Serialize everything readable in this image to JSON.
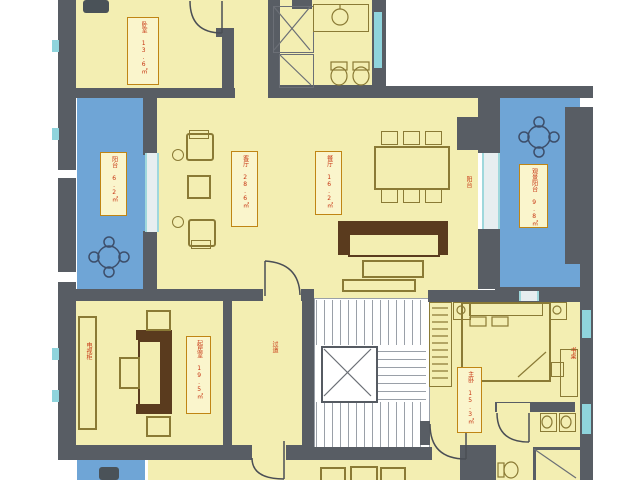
{
  "title": "apartment-floor-plan",
  "colors": {
    "room_fill": "#f3eeb2",
    "balcony_fill": "#6fa5d6",
    "wall": "#585d64",
    "label_border": "#c08514",
    "label_fill": "#faf5cc",
    "label_text": "#c63310",
    "window": "#8fd4dc",
    "furniture": "#8a7a35",
    "sofa": "#5a3b1e"
  },
  "rooms": {
    "bedroom_top": {
      "label": "卧室 13.6㎡"
    },
    "balcony_left": {
      "label": "阳台 6.2㎡"
    },
    "living": {
      "label": "客厅 28.6㎡"
    },
    "dining": {
      "label": "餐厅 16.2㎡"
    },
    "balcony_right": {
      "label": "观景阳台 9.8㎡"
    },
    "family": {
      "label": "起居室 19.5㎡"
    },
    "master_bedroom": {
      "label": "主卧 15.3㎡"
    },
    "hallway": {
      "label": "过道"
    },
    "balcony_note": {
      "label": "阳台"
    },
    "tv_cabinet": {
      "label": "电视柜"
    },
    "desk": {
      "label": "书桌"
    }
  }
}
